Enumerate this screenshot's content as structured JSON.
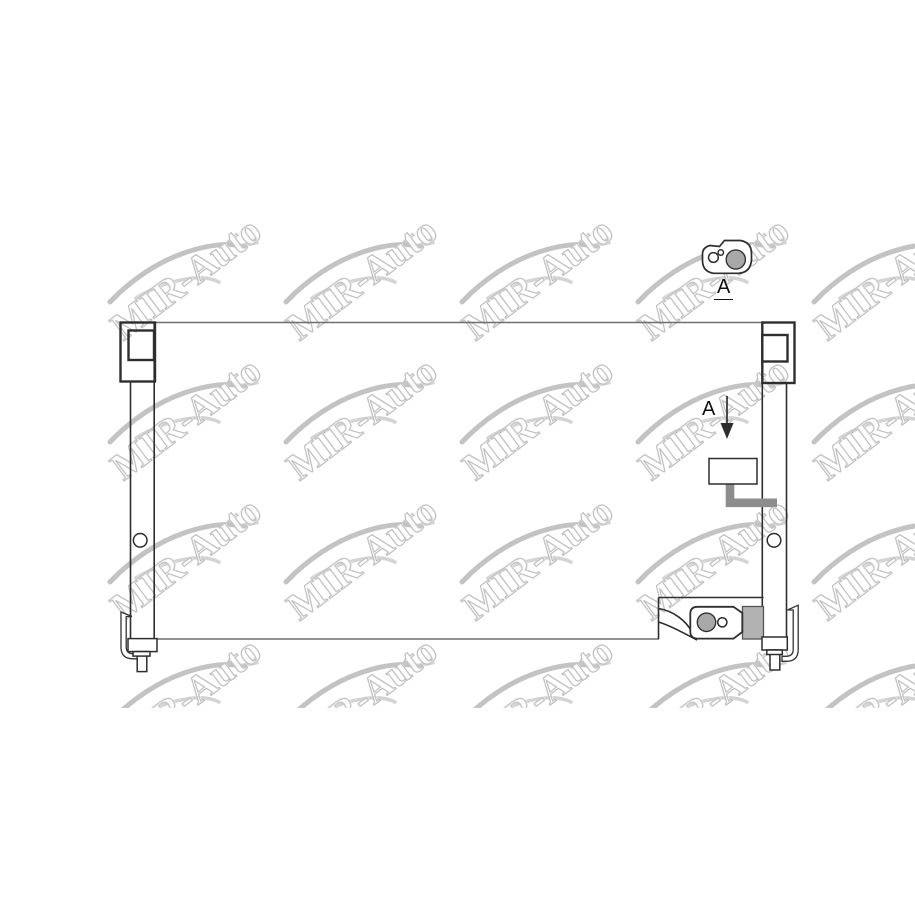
{
  "page": {
    "background": "#ffffff",
    "width": 915,
    "height": 915
  },
  "watermark": {
    "text": "MIR-Auto",
    "rows": 4,
    "cols": 5,
    "origin_x": 106,
    "origin_y": 228,
    "dx": 176,
    "dy": 140,
    "clip_bottom": 708,
    "text_color": "#c3c3c3",
    "car_color": "#b9b9b9",
    "car_color_light": "#cfcfcf"
  },
  "labels": {
    "detail_view_label": "A",
    "section_arrow_label": "A"
  },
  "colors": {
    "line_dark": "#2e2e2e",
    "line_medium": "#6f6f6f",
    "gray_fill": "#a8a8a8",
    "bracket_fill": "#b2b2b2",
    "pipe_gray": "#8d8d8d",
    "label_color": "#111111"
  }
}
